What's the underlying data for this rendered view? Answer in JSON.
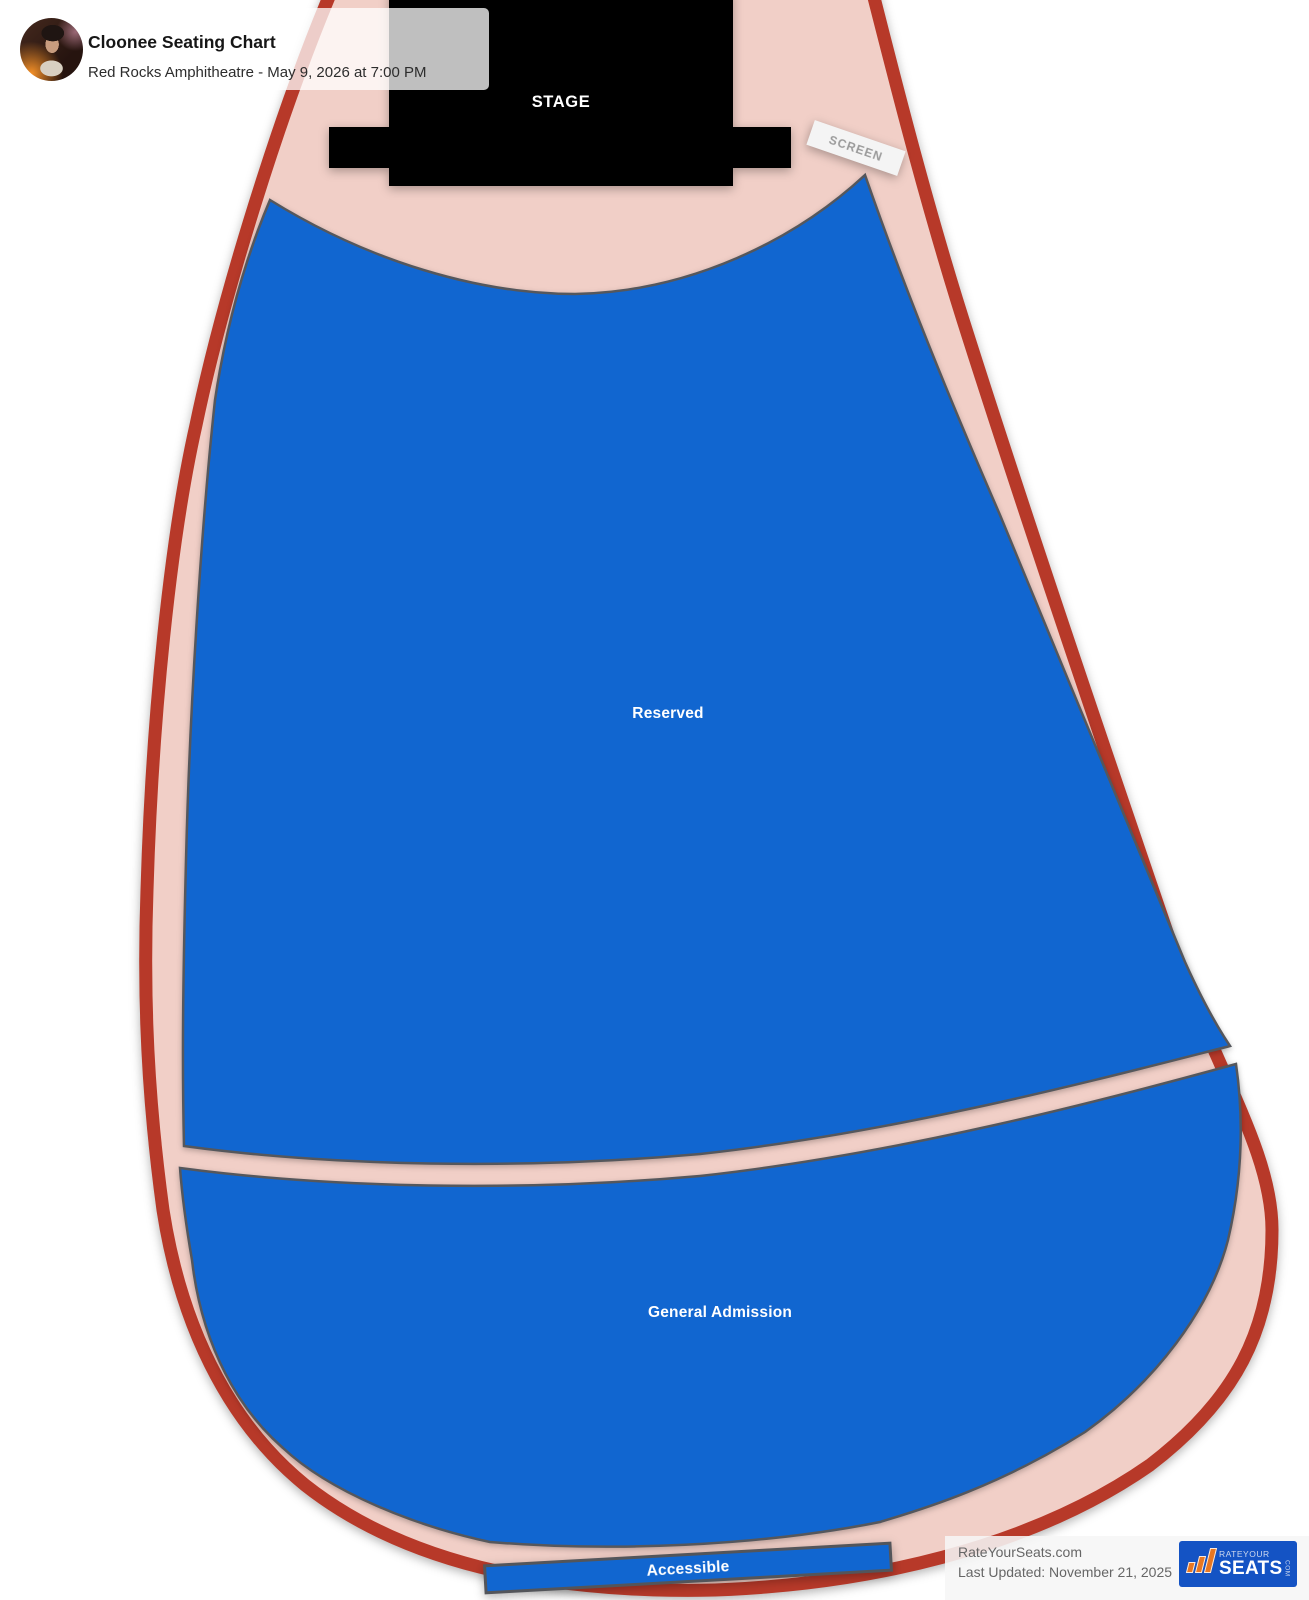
{
  "header": {
    "title": "Cloonee Seating Chart",
    "subtitle": "Red Rocks Amphitheatre - May 9, 2026 at 7:00 PM",
    "avatar_alt": "cloonee-artist-photo"
  },
  "venue": {
    "stage_label": "STAGE",
    "screen_label": "SCREEN",
    "sections": [
      {
        "id": "reserved",
        "label": "Reserved"
      },
      {
        "id": "general-admission",
        "label": "General Admission"
      },
      {
        "id": "accessible",
        "label": "Accessible"
      }
    ],
    "colors": {
      "outline_red": "#b73929",
      "walkway_pink": "#f1cfc7",
      "section_blue": "#1166d0",
      "section_border_gray": "#55575c",
      "stage_black": "#000000",
      "screen_box": "#f4f4f4"
    }
  },
  "footer": {
    "site": "RateYourSeats.com",
    "last_updated": "Last Updated: November 21, 2025",
    "logo": {
      "word_top": "RATEYOUR",
      "word_main": "SEATS",
      "word_suffix": "COM",
      "bg": "#1453c4",
      "accent": "#e87722"
    }
  }
}
